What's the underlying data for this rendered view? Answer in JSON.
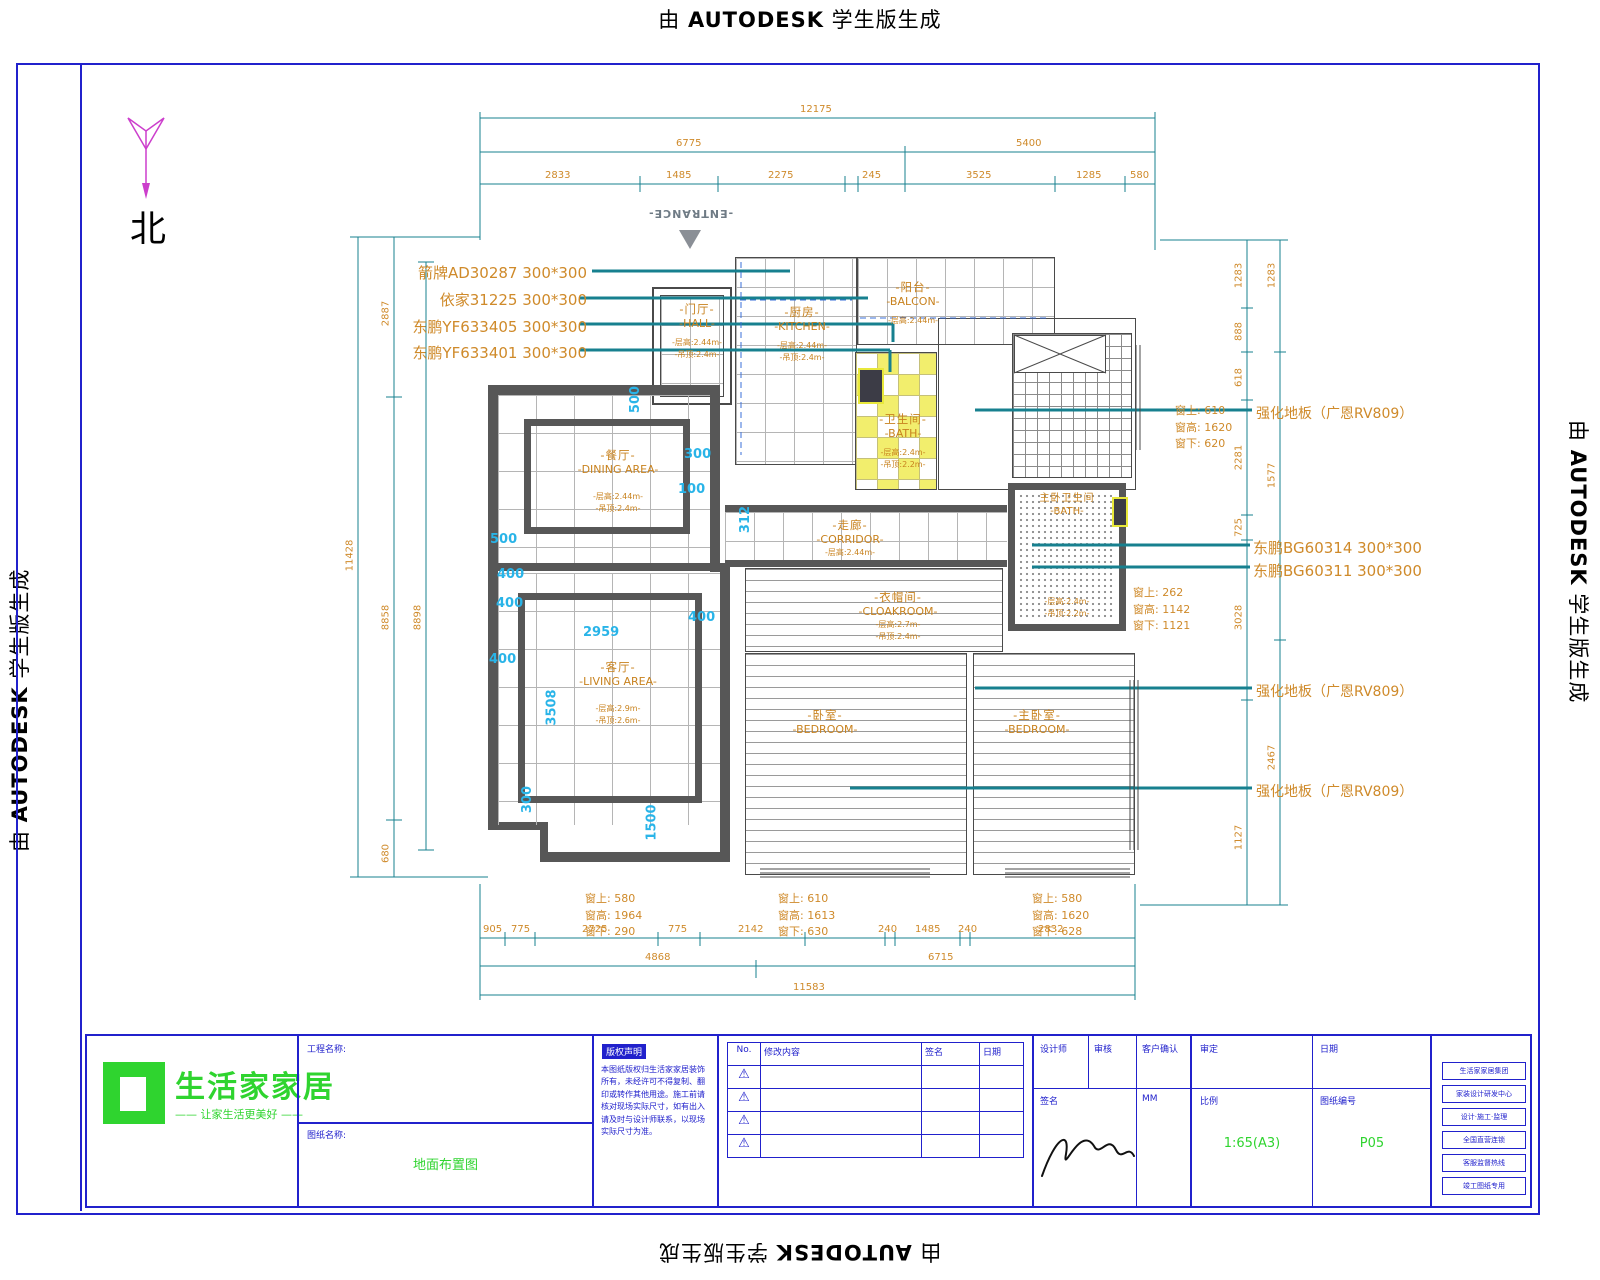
{
  "watermark": {
    "prefix": "由 ",
    "brand": "AUTODESK",
    "suffix": " 学生版生成"
  },
  "compass": {
    "north": "北"
  },
  "entrance": {
    "label": "-ENTRANCE-"
  },
  "tile_specs": [
    "箭牌AD30287  300*300",
    "依家31225  300*300",
    "东鹏YF633405  300*300",
    "东鹏YF633401  300*300"
  ],
  "right_labels": {
    "floor_top": "强化地板（广恩RV809）",
    "floor_mid": "强化地板（广恩RV809）",
    "floor_bottom": "强化地板（广恩RV809）",
    "tile_a": "东鹏BG60314  300*300",
    "tile_b": "东鹏BG60311  300*300"
  },
  "rooms": {
    "hall": {
      "cn": "-门厅-",
      "en": "-HALL-",
      "n1": "-层高:2.44m-",
      "n2": "-吊顶:2.4m-"
    },
    "kitchen": {
      "cn": "-厨房-",
      "en": "-KITCHEN-",
      "n1": "-层高:2.44m-",
      "n2": "-吊顶:2.4m-"
    },
    "balcony": {
      "cn": "-阳台-",
      "en": "-BALCON-",
      "n1": "-层高:2.44m-",
      "n2": "-吊顶:2.4m-"
    },
    "bath": {
      "cn": "-卫生间-",
      "en": "-BATH-",
      "n1": "-层高:2.4m-",
      "n2": "-吊顶:2.2m-"
    },
    "dining": {
      "cn": "-餐厅-",
      "en": "-DINING AREA-",
      "n1": "-层高:2.44m-",
      "n2": "-吊顶:2.4m-"
    },
    "corridor": {
      "cn": "-走廊-",
      "en": "-CORRIDOR-",
      "n1": "-层高:2.44m-",
      "n2": "-吊顶:2.4m-"
    },
    "cloakroom": {
      "cn": "-衣帽间-",
      "en": "-CLOAKROOM-",
      "n1": "-层高:2.7m-",
      "n2": "-吊顶:2.4m-"
    },
    "living": {
      "cn": "-客厅-",
      "en": "-LIVING AREA-",
      "n1": "-层高:2.9m-",
      "n2": "-吊顶:2.6m-"
    },
    "bedroom_left": {
      "cn": "-卧室-",
      "en": "-BEDROOM-"
    },
    "bedroom_right": {
      "cn": "-主卧室-",
      "en": "-BEDROOM-"
    },
    "master_bath": {
      "cn": "主卧卫生间",
      "en": "-BATH-",
      "n1": "-层高:2.4m-",
      "n2": "-吊顶:2.2m-"
    }
  },
  "windows": {
    "right_top": [
      "窗上: 610",
      "窗高: 1620",
      "窗下: 620"
    ],
    "right_mid": [
      "窗上: 262",
      "窗高: 1142",
      "窗下: 1121"
    ],
    "bottom_left": [
      "窗上: 580",
      "窗高: 1964",
      "窗下: 290"
    ],
    "bottom_mid": [
      "窗上: 610",
      "窗高: 1613",
      "窗下: 630"
    ],
    "bottom_right": [
      "窗上: 580",
      "窗高: 1620",
      "窗下: 628"
    ]
  },
  "dims": {
    "top_overall": "12175",
    "top_row2": [
      "6775",
      "5400"
    ],
    "top_row3": [
      "2833",
      "1485",
      "2275",
      "245",
      "3525",
      "1285",
      "580"
    ],
    "bottom_row1": [
      "905",
      "775",
      "2725",
      "775",
      "2142",
      "240",
      "1485",
      "240",
      "2832"
    ],
    "bottom_row2": [
      "4868",
      "6715"
    ],
    "bottom_overall": "11583",
    "left_overall": "11428",
    "left_col2": [
      "2887",
      "8858",
      "680"
    ],
    "left_col3": [
      "8898"
    ],
    "right_col1": [
      "1283",
      "888",
      "618",
      "2281",
      "725",
      "3028",
      "1127"
    ],
    "right_col2": [
      "1283",
      "1577",
      "2467"
    ]
  },
  "offsets": [
    "500",
    "300",
    "100",
    "312",
    "500",
    "400",
    "400",
    "400",
    "400",
    "2959",
    "3508",
    "300",
    "1500"
  ],
  "title_block": {
    "logo_name": "生活家家居",
    "logo_tagline": "—— 让家生活更美好 ——",
    "project_label": "工程名称:",
    "drawing_label": "图纸名称:",
    "drawing_value": "地面布置图",
    "notice_title": "版权声明",
    "notice_body": "本图纸版权归生活家家居装饰所有，未经许可不得复制、翻印或转作其他用途。施工前请核对现场实际尺寸，如有出入请及时与设计师联系，以现场实际尺寸为准。",
    "rev_headers": {
      "no": "No.",
      "desc": "修改内容",
      "sign": "签名",
      "date": "日期"
    },
    "cells": {
      "designer": "设计师",
      "checker": "审核",
      "client": "客户确认",
      "sign": "签名",
      "unit": "MM",
      "approve": "审定",
      "date": "日期",
      "scale_label": "比例",
      "scale_value": "1:65(A3)",
      "sheet_label": "图纸编号",
      "sheet_value": "P05"
    },
    "side_boxes": [
      "生活家家居集团",
      "家装设计研发中心",
      "设计·施工·监理",
      "全国直营连锁",
      "客服监督热线",
      "竣工图纸专用"
    ]
  }
}
